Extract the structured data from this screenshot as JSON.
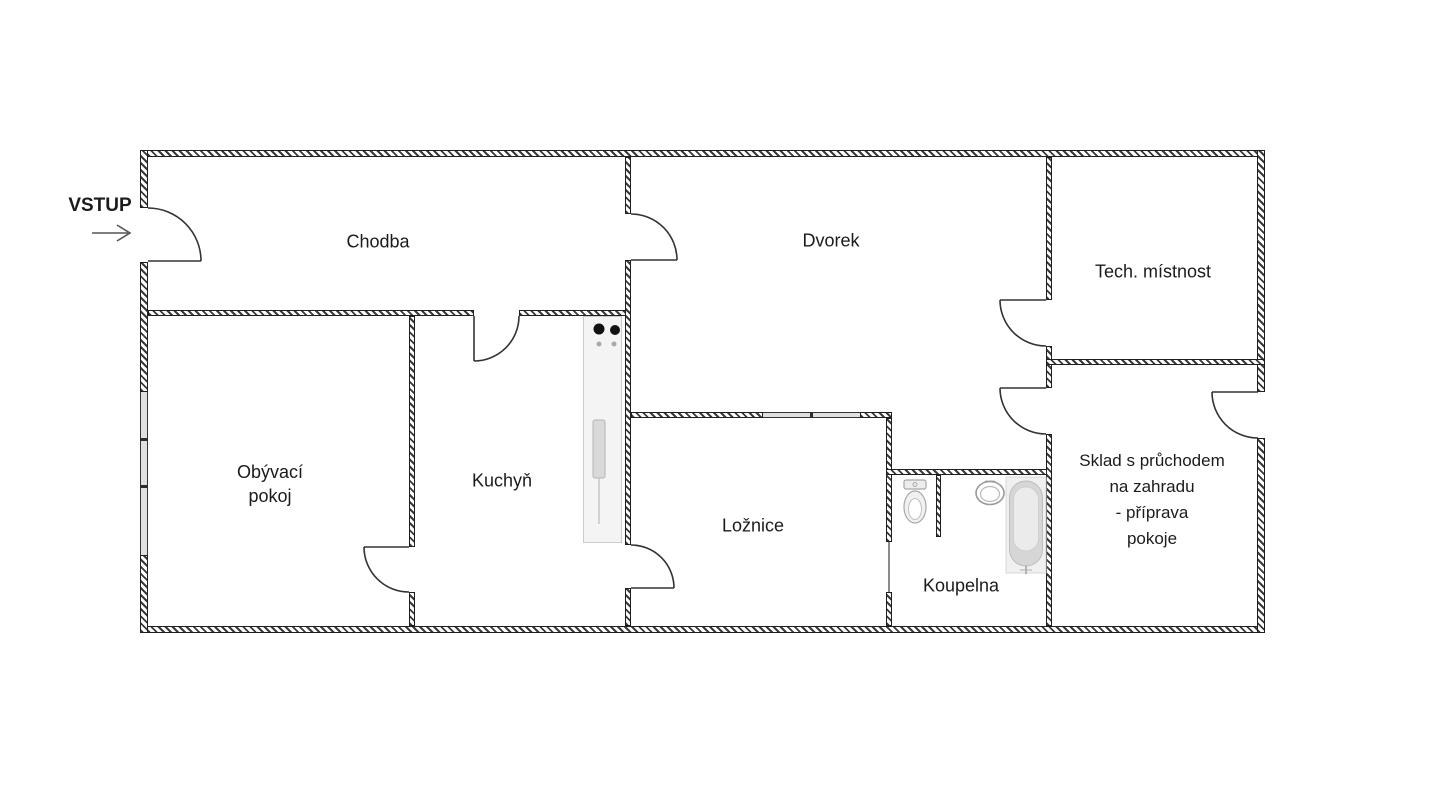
{
  "title": "Floor plan",
  "entrance": {
    "label": "VSTUP",
    "arrow_icon": "right-arrow"
  },
  "rooms": {
    "chodba": {
      "label": "Chodba"
    },
    "dvorek": {
      "label": "Dvorek"
    },
    "tech_mistnost": {
      "label": "Tech. místnost"
    },
    "obyvaci_pokoj": {
      "line1": "Obývací",
      "line2": "pokoj"
    },
    "kuchyn": {
      "label": "Kuchyň"
    },
    "loznice": {
      "label": "Ložnice"
    },
    "koupelna": {
      "label": "Koupelna"
    },
    "sklad": {
      "line1": "Sklad s průchodem",
      "line2": "na zahradu",
      "line3": "- příprava",
      "line4": "pokoje"
    }
  },
  "fixtures": {
    "bathtub": "bathtub",
    "toilet": "toilet",
    "washbasin": "washbasin",
    "stove": "stove-burners",
    "kitchen_counter": "kitchen-counter-with-sink"
  },
  "colors": {
    "line": "#333333",
    "wall_hatch": "#3a3a3a",
    "window_fill": "#e0e0e0",
    "fixture_gray": "#d6d6d6",
    "counter_fill": "#f4f4f4",
    "arrow": "#555555"
  }
}
